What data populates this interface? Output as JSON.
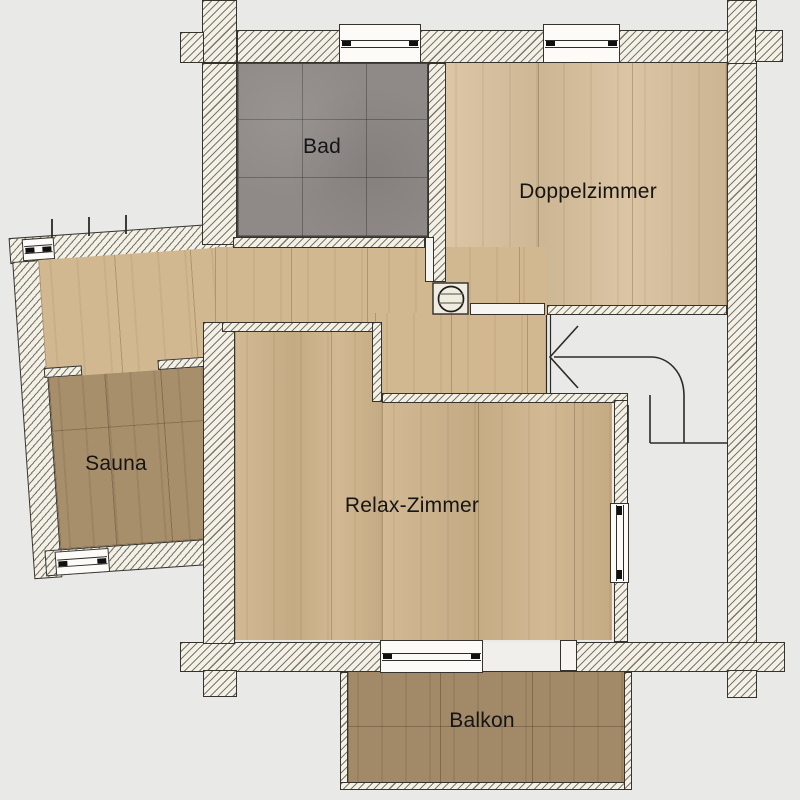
{
  "title": "Obergeschoss Grundriss",
  "rooms": [
    {
      "id": "bad",
      "label": "Bad",
      "floor": "gray-tile"
    },
    {
      "id": "doppelzimmer",
      "label": "Doppelzimmer",
      "floor": "light-wood"
    },
    {
      "id": "sauna",
      "label": "Sauna",
      "floor": "dark-wood"
    },
    {
      "id": "relax-zimmer",
      "label": "Relax-Zimmer",
      "floor": "light-wood"
    },
    {
      "id": "balkon",
      "label": "Balkon",
      "floor": "dark-wood"
    }
  ],
  "fixtures": [
    "stair-direction-arrow",
    "washbasin",
    "windows",
    "door-openings"
  ],
  "colors": {
    "background": "#e9e9e8",
    "wall_fill": "#f3f0e8",
    "wall_hatch": "#76705f",
    "wall_outline": "#35332c",
    "wood_light": "#d5bb95",
    "wood_dark": "#a88f6c",
    "tile_gray": "#8f8a88",
    "linework": "#2b2a26"
  }
}
